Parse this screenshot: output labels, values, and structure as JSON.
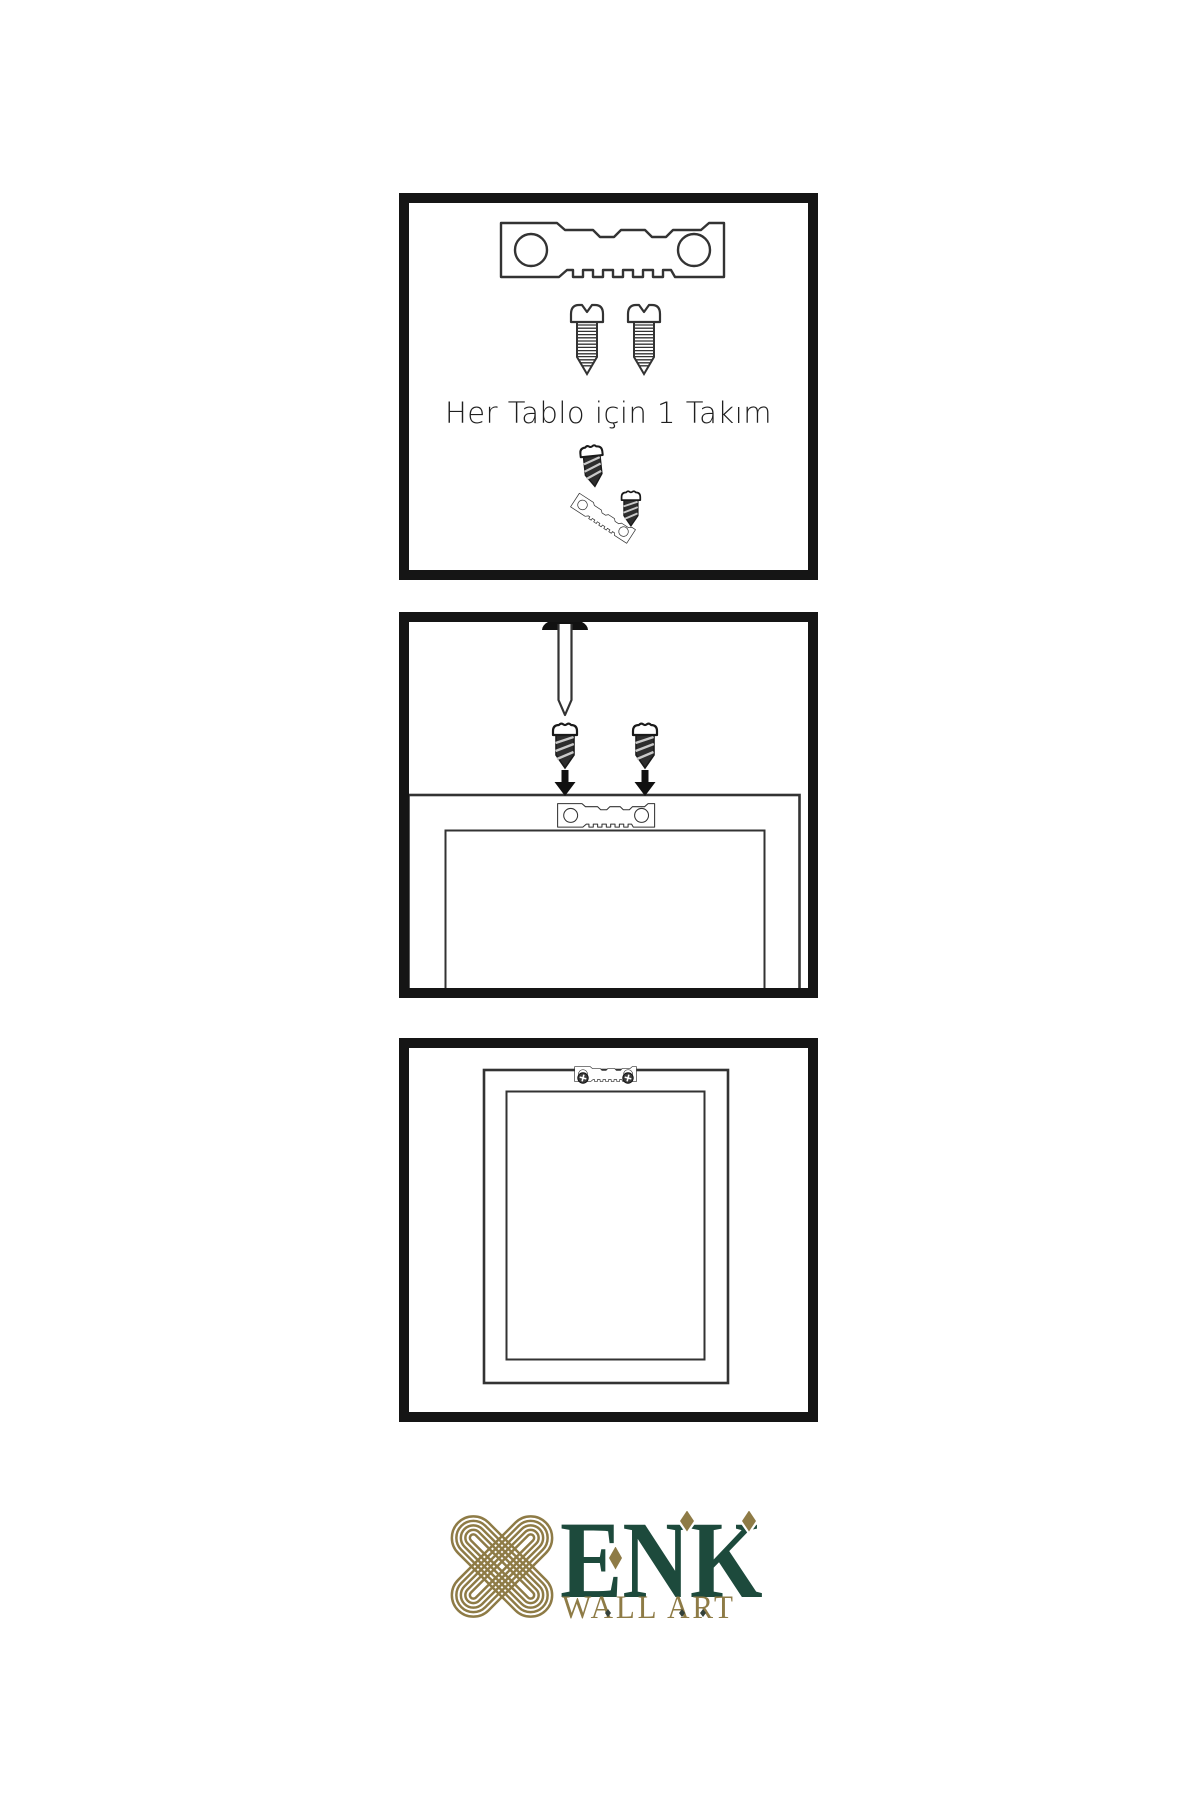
{
  "colors": {
    "background": "#ffffff",
    "line_art": "#333333",
    "panel_border": "#151515",
    "brand_gold": "#8e7b46",
    "brand_green": "#1d4a3c"
  },
  "steps": {
    "step1": {
      "caption": "Her Tablo için 1 Takım"
    }
  },
  "logo": {
    "wordmark": "ENK",
    "subtitle": "WALL ART"
  }
}
